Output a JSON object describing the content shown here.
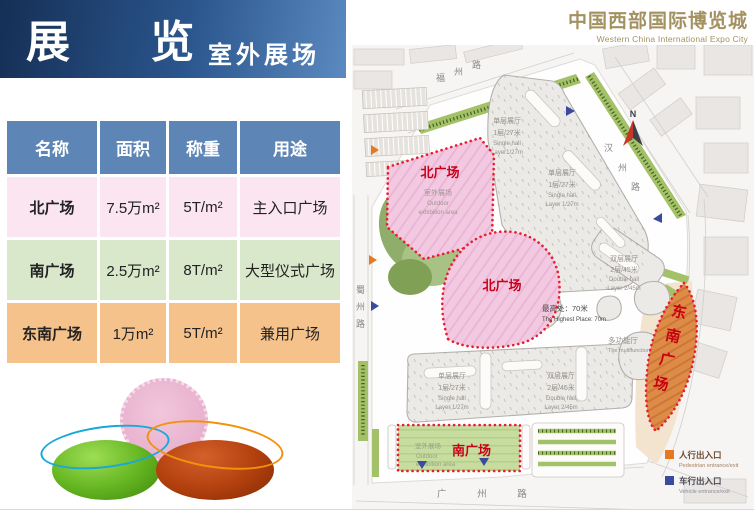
{
  "banner": {
    "title": "展 览",
    "subtitle": "室外展场"
  },
  "brand": {
    "title": "中国西部国际博览城",
    "subtitle": "Western China International  Expo City"
  },
  "table": {
    "headers": [
      "名称",
      "面积",
      "称重",
      "用途"
    ],
    "rows": [
      {
        "name": "北广场",
        "area": "7.5万m²",
        "load": "5T/m²",
        "usage": "主入口广场"
      },
      {
        "name": "南广场",
        "area": "2.5万m²",
        "load": "8T/m²",
        "usage": "大型仪式广场"
      },
      {
        "name": "东南广场",
        "area": "1万m²",
        "load": "5T/m²",
        "usage": "兼用广场"
      }
    ]
  },
  "map": {
    "roads": {
      "north": [
        "福",
        "州",
        "路"
      ],
      "east": [
        "汉",
        "州",
        "路"
      ],
      "west": [
        "蜀",
        "州",
        "路"
      ],
      "south": "广 州 路"
    },
    "compass": "N",
    "areas": {
      "north_upper": {
        "label": "北广场",
        "note_cn": "室外展场",
        "note_en1": "Outdoor",
        "note_en2": "exhibition area"
      },
      "north_lower": {
        "label": "北广场"
      },
      "south": {
        "label": "南广场",
        "note_cn": "室外展场",
        "note_en1": "Outdoor",
        "note_en2": "exhibition area"
      },
      "southeast": {
        "chars": [
          "东",
          "南",
          "广",
          "场"
        ]
      }
    },
    "halls": {
      "single_top": {
        "cn": "单层展厅",
        "spec": "1层/27米",
        "en1": "Single hall",
        "en2": "Layer1/27m"
      },
      "single_mid": {
        "cn": "单层展厅",
        "spec": "1层/27米",
        "en1": "Single hall",
        "en2": "Layer 1/27m"
      },
      "double_right": {
        "cn": "双层展厅",
        "spec": "2层/45米",
        "en1": "Double hall",
        "en2": "Layer 2/45m"
      },
      "single_bottom": {
        "cn": "单层展厅",
        "spec": "1层/27米",
        "en1": "Single hall",
        "en2": "Layer 1/27m"
      },
      "double_bottom": {
        "cn": "双层展厅",
        "spec": "2层/45米",
        "en1": "Double hall",
        "en2": "Layer 2/45m"
      }
    },
    "annotations": {
      "highest_cn": "最高处：70米",
      "highest_en": "The Highest Place: 70m",
      "multi_cn": "多功能厅",
      "multi_en": "The multifunction…"
    },
    "legend": {
      "pedestrian": {
        "cn": "人行出入口",
        "en": "Pedestrian entrance/exit",
        "color": "#e87722"
      },
      "vehicle": {
        "cn": "车行出入口",
        "en": "Vehicle entrance/exit",
        "color": "#3a4a9f"
      }
    }
  }
}
